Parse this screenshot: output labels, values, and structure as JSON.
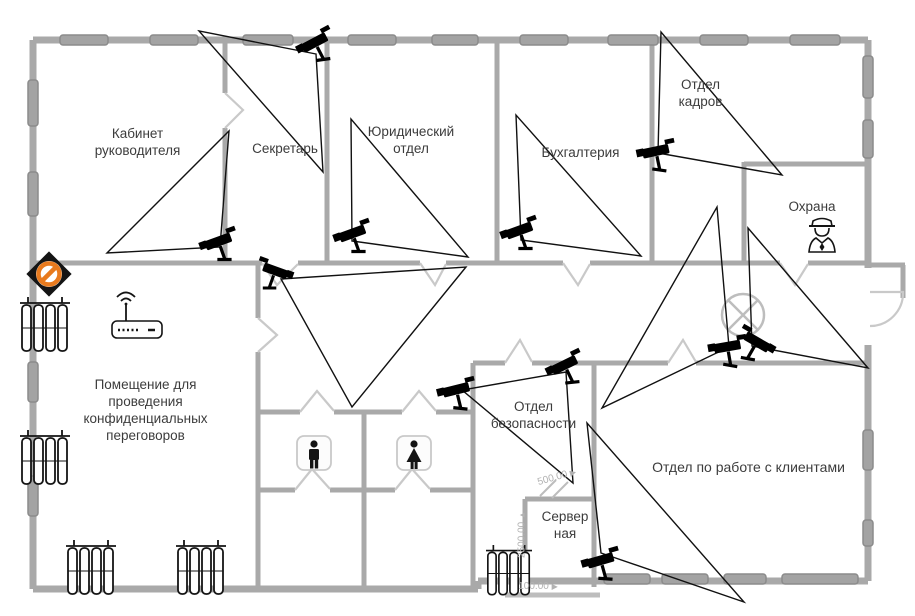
{
  "title": "Office floor plan with CCTV camera coverage",
  "rooms": {
    "director": {
      "label": "Кабинет руководителя"
    },
    "secretary": {
      "label": "Секретарь"
    },
    "legal": {
      "label": "Юридический отдел"
    },
    "accounting": {
      "label": "Бухгалтерия"
    },
    "hr": {
      "label": "Отдел кадров"
    },
    "guard_room": {
      "label": "Охрана"
    },
    "confidential": {
      "label": "Помещение для проведения конфиденциальных переговоров"
    },
    "security_dept": {
      "label": "Отдел безопасности"
    },
    "server_room": {
      "label": "Сервер ная"
    },
    "clients": {
      "label": "Отдел по работе с клиентами"
    }
  },
  "dims": {
    "vertical": "2500.00",
    "diagonal": "500.00",
    "horizontal": "100.00",
    "arrow_up": "▲",
    "arrow_right": "▶"
  },
  "icons": {
    "cctv_cameras": 11,
    "fov_triangles": 10,
    "no_entry_sign": 1,
    "wifi_router": 1,
    "security_guard": 1,
    "wc_male_sign": 1,
    "wc_female_sign": 1,
    "ceiling_light": 1,
    "radiators": 5
  },
  "colors": {
    "wall": "#a9a9a9",
    "window_fill": "#a3a3a3",
    "window_stroke": "#8b8b8b",
    "door": "#c9c9c9",
    "fov_line": "#111111",
    "no_entry_accent": "#e87a1e",
    "dimension": "#b2b2b2"
  }
}
